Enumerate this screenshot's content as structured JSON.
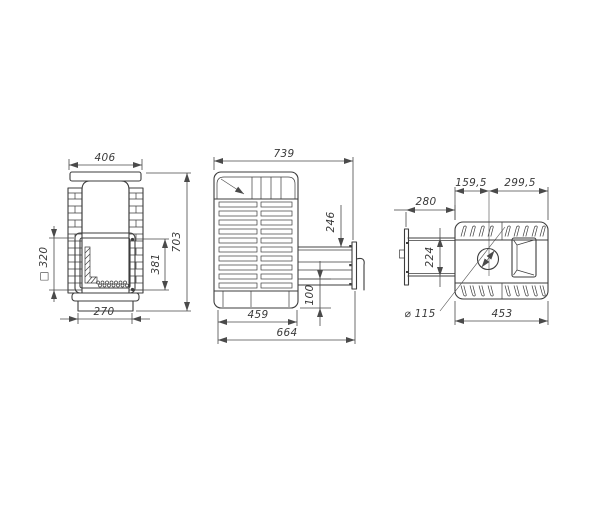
{
  "colors": {
    "line": "#3d3d3d",
    "dim": "#4a4a4a"
  },
  "front_view": {
    "overall_width": "406",
    "overall_height": "703",
    "door_height": "381",
    "firebox_opening": "□ 320",
    "base_width": "270"
  },
  "side_view": {
    "overall_depth": "739",
    "tunnel_opening_height": "246",
    "tunnel_bottom_offset": "100",
    "body_depth": "459",
    "depth_to_door_frame": "664"
  },
  "top_view": {
    "chimney_to_front_edge": "159,5",
    "chimney_to_back_edge": "299,5",
    "tunnel_length": "280",
    "tunnel_width": "224",
    "chimney_diameter": "⌀ 115",
    "body_width": "453"
  }
}
